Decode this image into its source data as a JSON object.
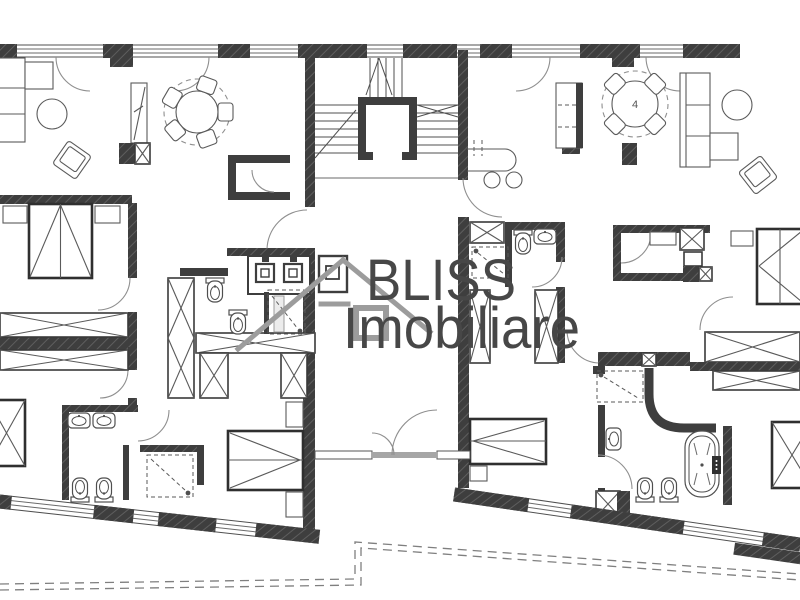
{
  "document": {
    "type": "apartment floor plan drawing",
    "background": "#ffffff"
  },
  "watermark": {
    "line1": "BLISS",
    "line2": "Imobiliare",
    "text_color": "#474747",
    "house_icon": "house-outline-icon",
    "house_icon_color": "#9c9c9c"
  },
  "labels": {
    "dining_table_seat_count": "4"
  },
  "palette": {
    "wall_fill": "#3e3e3e",
    "wall_hatch_line": "#5e5e5e",
    "drawing_line": "#4f4f4f",
    "furniture_line": "#5a5a5a",
    "light_gray": "#9c9c9c",
    "dashed_outline": "#7f7f7f",
    "threshold": "#a6a6a6"
  }
}
